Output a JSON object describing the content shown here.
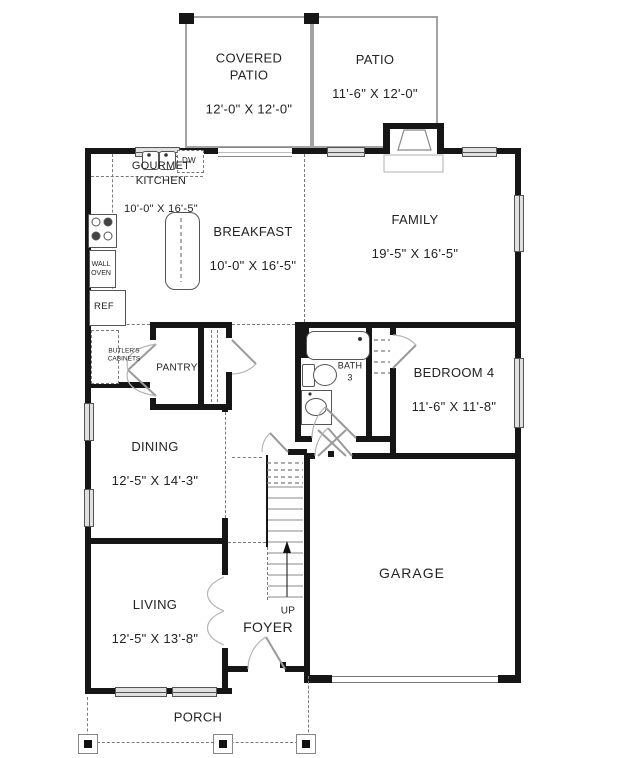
{
  "floorplan": {
    "rooms": {
      "covered_patio": {
        "name": "COVERED\nPATIO",
        "dims": "12'-0\" X 12'-0\""
      },
      "patio": {
        "name": "PATIO",
        "dims": "11'-6\" X 12'-0\""
      },
      "gourmet_kitchen": {
        "name": "GOURMET\nKITCHEN",
        "dims": "10'-0\" X 16'-5\""
      },
      "breakfast": {
        "name": "BREAKFAST",
        "dims": "10'-0\" X 16'-5\""
      },
      "family": {
        "name": "FAMILY",
        "dims": "19'-5\" X 16'-5\""
      },
      "bedroom_4": {
        "name": "BEDROOM 4",
        "dims": "11'-6\" X 11'-8\""
      },
      "bath_3": {
        "name": "BATH\n3"
      },
      "pantry": {
        "name": "PANTRY"
      },
      "dining": {
        "name": "DINING",
        "dims": "12'-5\" X 14'-3\""
      },
      "garage": {
        "name": "GARAGE"
      },
      "living": {
        "name": "LIVING",
        "dims": "12'-5\" X 13'-8\""
      },
      "foyer": {
        "name": "FOYER"
      },
      "porch": {
        "name": "PORCH"
      }
    },
    "annotations": {
      "dw": "DW",
      "wall_oven": "WALL\nOVEN",
      "ref": "REF",
      "butlers_cabinets": "BUTLER'S\nCABINETS",
      "stairs_up": "UP"
    },
    "colors": {
      "wall": "#161616",
      "thin_line": "#9a9a9a",
      "window_fill": "#e0e0e0",
      "text": "#232323"
    }
  }
}
